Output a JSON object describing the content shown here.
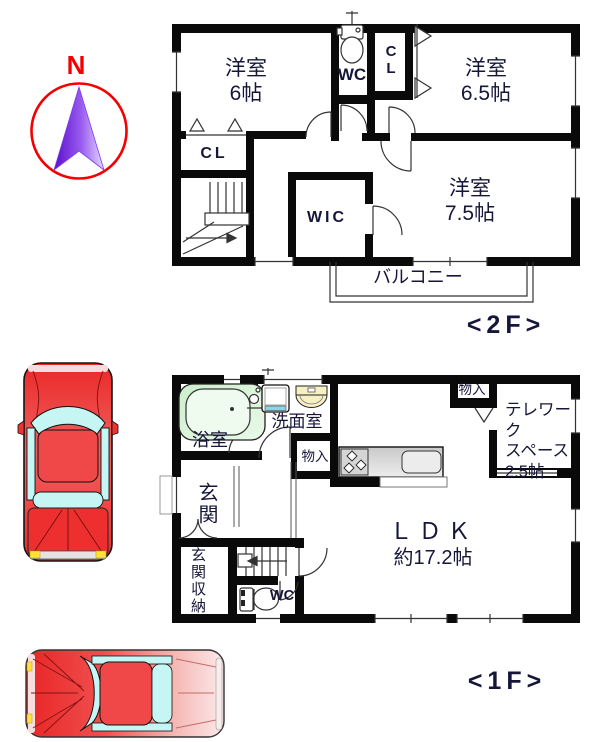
{
  "compass": {
    "north": "N"
  },
  "floor_2f": {
    "label": "<2F>",
    "rooms": {
      "bedroom_6_name": "洋室",
      "bedroom_6_size": "6帖",
      "bedroom_65_name": "洋室",
      "bedroom_65_size": "6.5帖",
      "bedroom_75_name": "洋室",
      "bedroom_75_size": "7.5帖",
      "wc": "WC",
      "closet_top": "C\nL",
      "closet_side": "CL",
      "wic": "WIC",
      "balcony": "バルコニー"
    }
  },
  "floor_1f": {
    "label": "<1F>",
    "rooms": {
      "bathroom": "浴室",
      "washroom": "洗面室",
      "storage_hall": "物入",
      "storage_ldk": "物入",
      "telework": "テレワーク\nスペース\n2.5帖",
      "entrance": "玄関",
      "entrance_storage": "玄関収納",
      "wc": "WC",
      "ldk_name": "ＬＤＫ",
      "ldk_size": "約17.2帖"
    }
  },
  "icons": {
    "compass-north-arrow": "purple gradient arrow in red circle",
    "toilet-icon": "tank + bowl outline",
    "bathtub-icon": "green rounded tub",
    "washbasin-icon": "yellow oval basin",
    "washing-machine-icon": "white square with cyan strip",
    "kitchen-counter-icon": "gray counter with burners and sink",
    "stairs-icon": "treads with direction arrow",
    "car-icon": "red car top view with cyan windows"
  },
  "colors": {
    "wall": "#0a0a0a",
    "accent_red": "#f40000",
    "arrow_purple": "#6a18e8",
    "car_red": "#ee2e2e",
    "window_cyan": "#c6f6f4",
    "tub_green": "#d7f2d4",
    "sink_yellow": "#f6f0c4",
    "counter_gray": "#d9d9d9"
  }
}
